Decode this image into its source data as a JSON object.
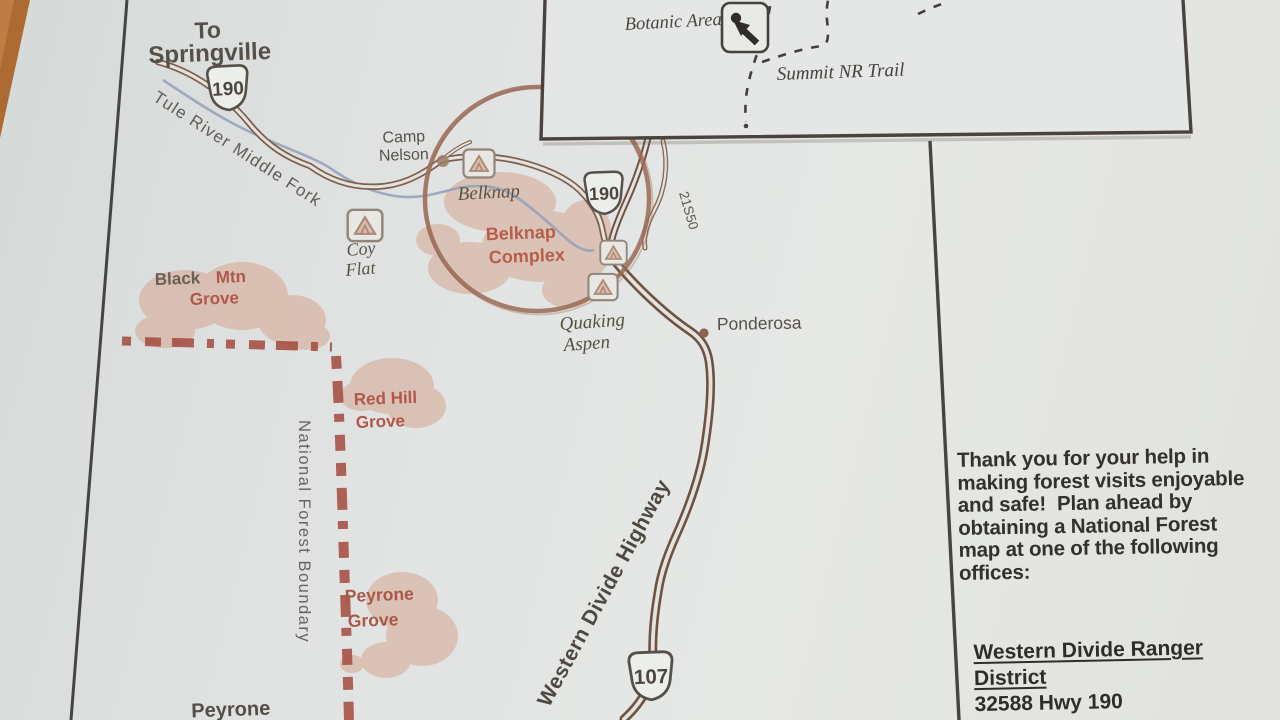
{
  "map": {
    "title_destination": {
      "line1": "To",
      "line2": "Springville"
    },
    "river_label": "Tule River Middle Fork",
    "shields": {
      "hwy_190": "190",
      "hwy_107": "107"
    },
    "road_labels": {
      "forest_road": "21S50",
      "western_divide_highway": "Western Divide Highway"
    },
    "boundary_label": "National Forest Boundary",
    "places": {
      "camp_nelson_line1": "Camp",
      "camp_nelson_line2": "Nelson",
      "belknap": "Belknap",
      "coy_flat_line1": "Coy",
      "coy_flat_line2": "Flat",
      "quaking_aspen_line1": "Quaking",
      "quaking_aspen_line2": "Aspen",
      "ponderosa": "Ponderosa",
      "peyrone": "Peyrone"
    },
    "groves": {
      "black_mtn_word1": "Black",
      "black_mtn_word2": "Mtn",
      "black_mtn_line2": "Grove",
      "belknap_complex_line1": "Belknap",
      "belknap_complex_line2": "Complex",
      "red_hill_line1": "Red Hill",
      "red_hill_line2": "Grove",
      "peyrone_grove_line1": "Peyrone",
      "peyrone_grove_line2": "Grove"
    },
    "inset": {
      "botanic_area": "Botanic Area",
      "summit_trail": "Summit NR Trail"
    }
  },
  "sidebar": {
    "message": "Thank you for your help in\nmaking forest visits enjoyable\nand safe!  Plan ahead by\nobtaining a National Forest\nmap at one of the following\noffices:",
    "office_name_line1": "Western Divide Ranger",
    "office_name_line2": "District",
    "office_address": "32588 Hwy 190"
  },
  "colors": {
    "paper": "#e2e4e2",
    "wood": "#b06f38",
    "road_brown": "#7f5f4c",
    "highway_dark": "#6f523f",
    "grove_pink": "#d8b4a3",
    "boundary_red": "#a3493d",
    "ink_dark": "#4a443e",
    "river_blue": "#93a0b8",
    "marker_circle": "#9a6a54"
  }
}
